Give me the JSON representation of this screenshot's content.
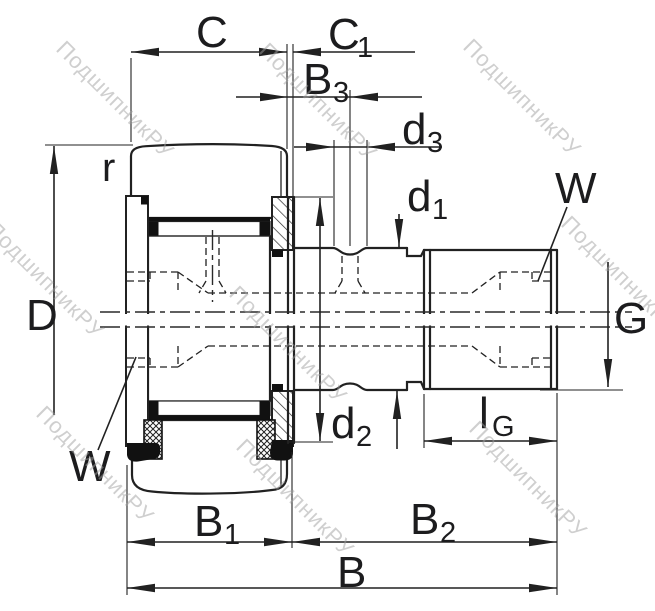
{
  "watermark": {
    "text": "ПодшипникРУ"
  },
  "colors": {
    "line": "#212121",
    "label": "#1c1c1e",
    "watermark": "#a0a0a0"
  },
  "labels": {
    "C": {
      "base": "C"
    },
    "C1": {
      "base": "C",
      "sub": "1"
    },
    "B3": {
      "base": "B",
      "sub": "3"
    },
    "d3": {
      "base": "d",
      "sub": "3"
    },
    "d1": {
      "base": "d",
      "sub": "1"
    },
    "W_right": {
      "base": "W"
    },
    "r": {
      "base": "r"
    },
    "D": {
      "base": "D"
    },
    "G": {
      "base": "G"
    },
    "d2": {
      "base": "d",
      "sub": "2"
    },
    "lG": {
      "base": "l",
      "sub": "G"
    },
    "W_left": {
      "base": "W"
    },
    "B1": {
      "base": "B",
      "sub": "1"
    },
    "B2": {
      "base": "B",
      "sub": "2"
    },
    "B": {
      "base": "B"
    }
  }
}
